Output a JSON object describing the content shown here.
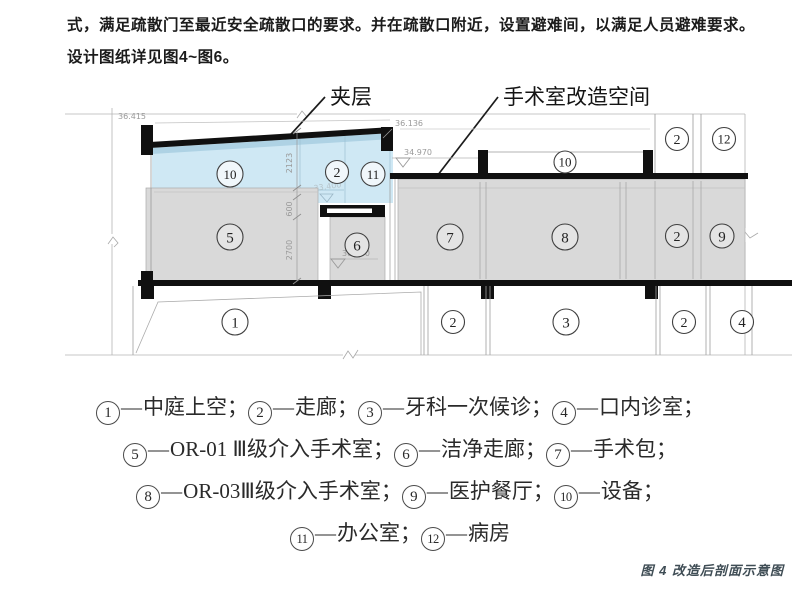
{
  "page": {
    "paragraph_line1": "式，满足疏散门至最近安全疏散口的要求。并在疏散口附近，设置避难间，以满足人员避难要求。",
    "paragraph_line2": "设计图纸详见图4~图6。",
    "figure_caption": "图 4 改造后剖面示意图"
  },
  "diagram": {
    "callouts": {
      "mezzanine": "夹层",
      "or_space": "手术室改造空间"
    },
    "elevations": {
      "e_36415": "36.415",
      "e_36136": "36.136",
      "e_34970": "34.970",
      "e_33400": "33.400",
      "e_30100": "30.100"
    },
    "dimensions": {
      "d_2123": "2123",
      "d_600": "600",
      "d_2700": "2700"
    },
    "colors": {
      "mezzanine_blue": "#cfe8f4",
      "room_gray": "#d9d9d9",
      "structure_black": "#101010"
    }
  },
  "legend": {
    "dash": "—",
    "separator": "；",
    "items": [
      {
        "num": "1",
        "label": "中庭上空"
      },
      {
        "num": "2",
        "label": "走廊"
      },
      {
        "num": "3",
        "label": "牙科一次候诊"
      },
      {
        "num": "4",
        "label": "口内诊室"
      },
      {
        "num": "5",
        "label": "OR-01 Ⅲ级介入手术室"
      },
      {
        "num": "6",
        "label": "洁净走廊"
      },
      {
        "num": "7",
        "label": "手术包"
      },
      {
        "num": "8",
        "label": "OR-03Ⅲ级介入手术室"
      },
      {
        "num": "9",
        "label": "医护餐厅"
      },
      {
        "num": "10",
        "label": "设备"
      },
      {
        "num": "11",
        "label": "办公室"
      },
      {
        "num": "12",
        "label": "病房"
      }
    ]
  }
}
